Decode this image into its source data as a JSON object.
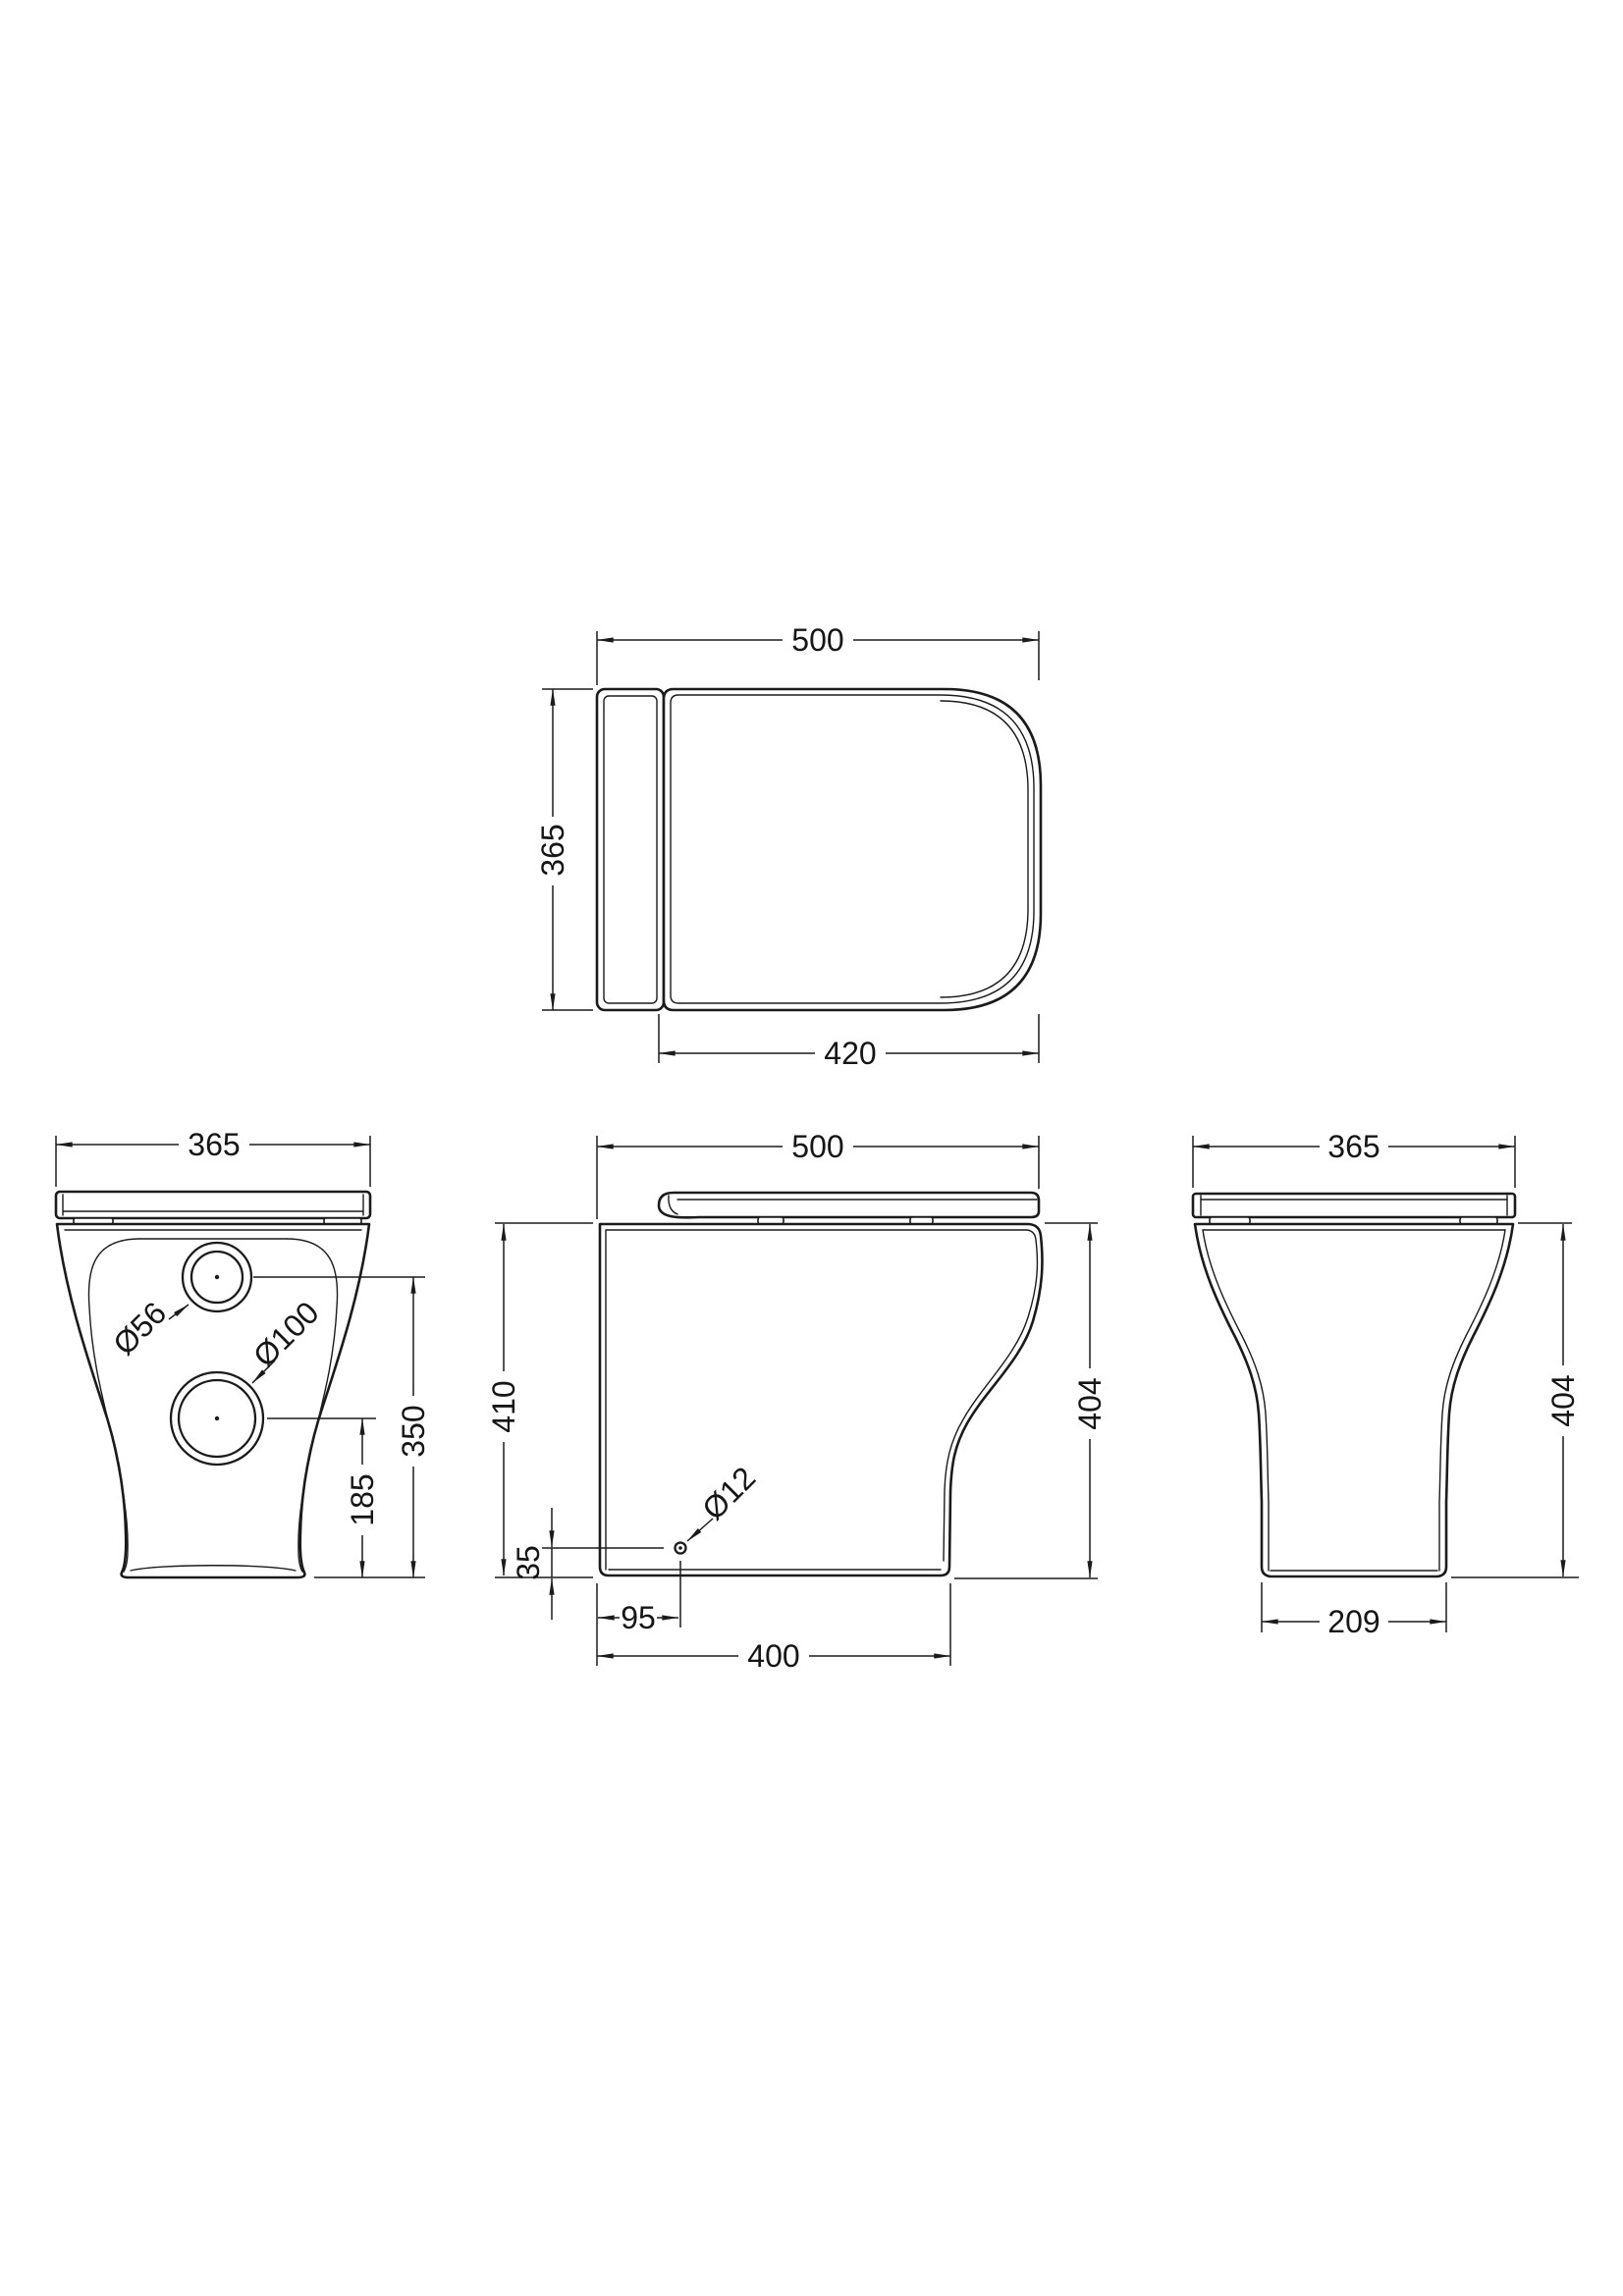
{
  "drawing": {
    "background": "#ffffff",
    "line_color": "#1b1b1b",
    "views": {
      "top": {
        "dims": {
          "width": "500",
          "depth": "365",
          "seat": "420"
        }
      },
      "rear": {
        "dims": {
          "width": "365",
          "inlet_height": "350",
          "outlet_height": "185"
        },
        "callouts": {
          "inlet": "Ø56",
          "outlet": "Ø100"
        }
      },
      "side": {
        "dims": {
          "depth": "500",
          "height": "410",
          "pan_height": "404",
          "hole_up": "35",
          "hole_back": "95",
          "base": "400"
        },
        "callouts": {
          "hole": "Ø12"
        }
      },
      "front": {
        "dims": {
          "width": "365",
          "pan_height": "404",
          "base": "209"
        }
      }
    }
  }
}
